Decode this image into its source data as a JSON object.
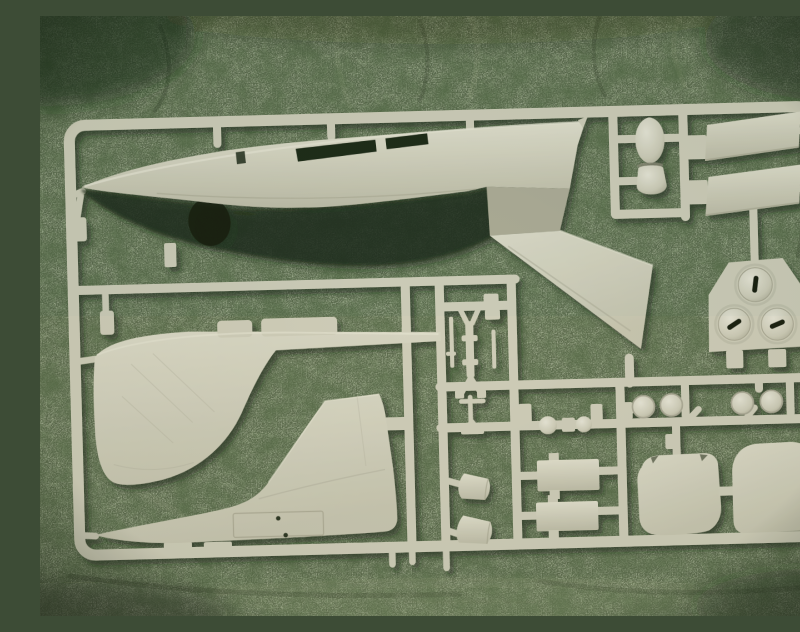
{
  "scene": {
    "type": "photograph",
    "caption": "Plastic scale-model kit sprue with unassembled aircraft parts, photographed lying on a mottled green carpet",
    "no_visible_text": true
  },
  "palette": {
    "carpet_base": "#5c6c4e",
    "carpet_dark_vein": "#27331f",
    "carpet_light_fleck": "#b8c79e",
    "plastic": "#d7d5c1",
    "plastic_light": "#e9e7d5",
    "plastic_shadow": "#b3b19c",
    "opening_dark": "#1d2916",
    "deep_shadow": "#141d0f"
  },
  "sprue": {
    "frame": {
      "shape": "rounded rectangle runner frame",
      "material": "light cream-grey styrene",
      "tilt_degrees": -1.5
    },
    "parts": [
      {
        "id": "fuselage-half",
        "label": "Fuselage half",
        "details": "long fuselage side with two rectangular window openings, nose at left",
        "count": 1
      },
      {
        "id": "wing-half",
        "label": "Swept wing half",
        "details": "joined at rear of fuselage piece, sweeping down to the right",
        "count": 1
      },
      {
        "id": "wing-fairing-half",
        "label": "Lower fuselage / wing fairing half",
        "details": "swoosh-shaped piece with raised spine pads, middle left",
        "count": 1
      },
      {
        "id": "tail-section",
        "label": "Rear fuselage with vertical tail fin",
        "details": "bottom-left piece with rectangular access panel and two rivet marks",
        "count": 1
      },
      {
        "id": "drop-tank-half",
        "label": "Drop-tank half",
        "details": "teardrop part held in a small sub-frame",
        "count": 1
      },
      {
        "id": "flap-panel",
        "label": "Trapezoidal flap panel",
        "details": "two slanted panels on the upper right",
        "count": 2
      },
      {
        "id": "wheel-hub-plate",
        "label": "Wheel-hub plate",
        "details": "plate carrying three domed hubs, each with a dark keyed slot",
        "count": 1
      },
      {
        "id": "landing-gear-strut",
        "label": "Landing-gear strut cluster",
        "details": "Y-shaped leg, collars and thin brackets in a sub-frame",
        "count": 1
      },
      {
        "id": "equipment-box",
        "label": "Rectangular equipment box",
        "details": "two stacked rectangular parts, bottom centre",
        "count": 2
      },
      {
        "id": "intake-cone",
        "label": "Conical intake part",
        "details": "two truncated cones left of the boxes",
        "count": 2
      },
      {
        "id": "small-wheel",
        "label": "Small dome wheel",
        "details": "two pairs on the lower-right runner",
        "count": 4
      },
      {
        "id": "round-knob",
        "label": "Ball / cylinder fitting",
        "details": "small round parts on the centre runner",
        "count": 3
      },
      {
        "id": "hatch-door",
        "label": "Rounded hatch door",
        "details": "two large rounded panels, bottom right",
        "count": 2
      }
    ]
  }
}
